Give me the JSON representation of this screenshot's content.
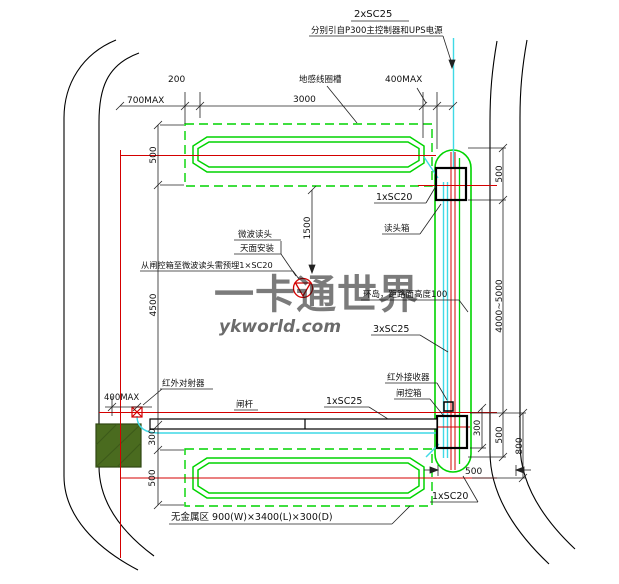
{
  "labels": {
    "conduit_2xsc25": "2xSC25",
    "feed_note": "分别引自P300主控制器和UPS电源",
    "loop_slot": "地感线圈槽",
    "reader_conduit": "1xSC20",
    "reader_box": "读头箱",
    "mw_head": "微波读头",
    "mw_mount": "天面安装",
    "mw_conduit_note": "从闸控箱至微波读头需预埋1×SC20",
    "island_note": "环岛，距路面高度100",
    "conduit_3xsc25": "3xSC25",
    "ir_emitter": "红外对射器",
    "barrier_arm": "闸杆",
    "conduit_1xsc25": "1xSC25",
    "ir_receiver": "红外接收器",
    "gate_ctrl_box": "闸控箱",
    "bottom_conduit": "1xSC20",
    "no_metal_zone": "无金属区 900(W)×3400(L)×300(D)"
  },
  "dims": {
    "d700max": "700MAX",
    "d200": "200",
    "d3000": "3000",
    "d400max_top": "400MAX",
    "d500_tl": "500",
    "d4500": "4500",
    "d400max_l": "400MAX",
    "d300_l": "300",
    "d500_bl": "500",
    "d1500": "1500",
    "d500_tr": "500",
    "d4000_5000": "4000~5000",
    "d300_r": "300",
    "d500_rb": "500",
    "d800": "800",
    "d500_bh": "500"
  },
  "watermark": {
    "cn": "一卡通世界",
    "url": "ykworld.com"
  },
  "colors": {
    "loop_green": "#00d400",
    "wire_cyan": "#3fd9e6",
    "axis_red": "#d40000",
    "cabinet_olive": "#4a6b1f",
    "wm_blue": "#a9c9e4",
    "wm_orange": "#f2a95f"
  }
}
